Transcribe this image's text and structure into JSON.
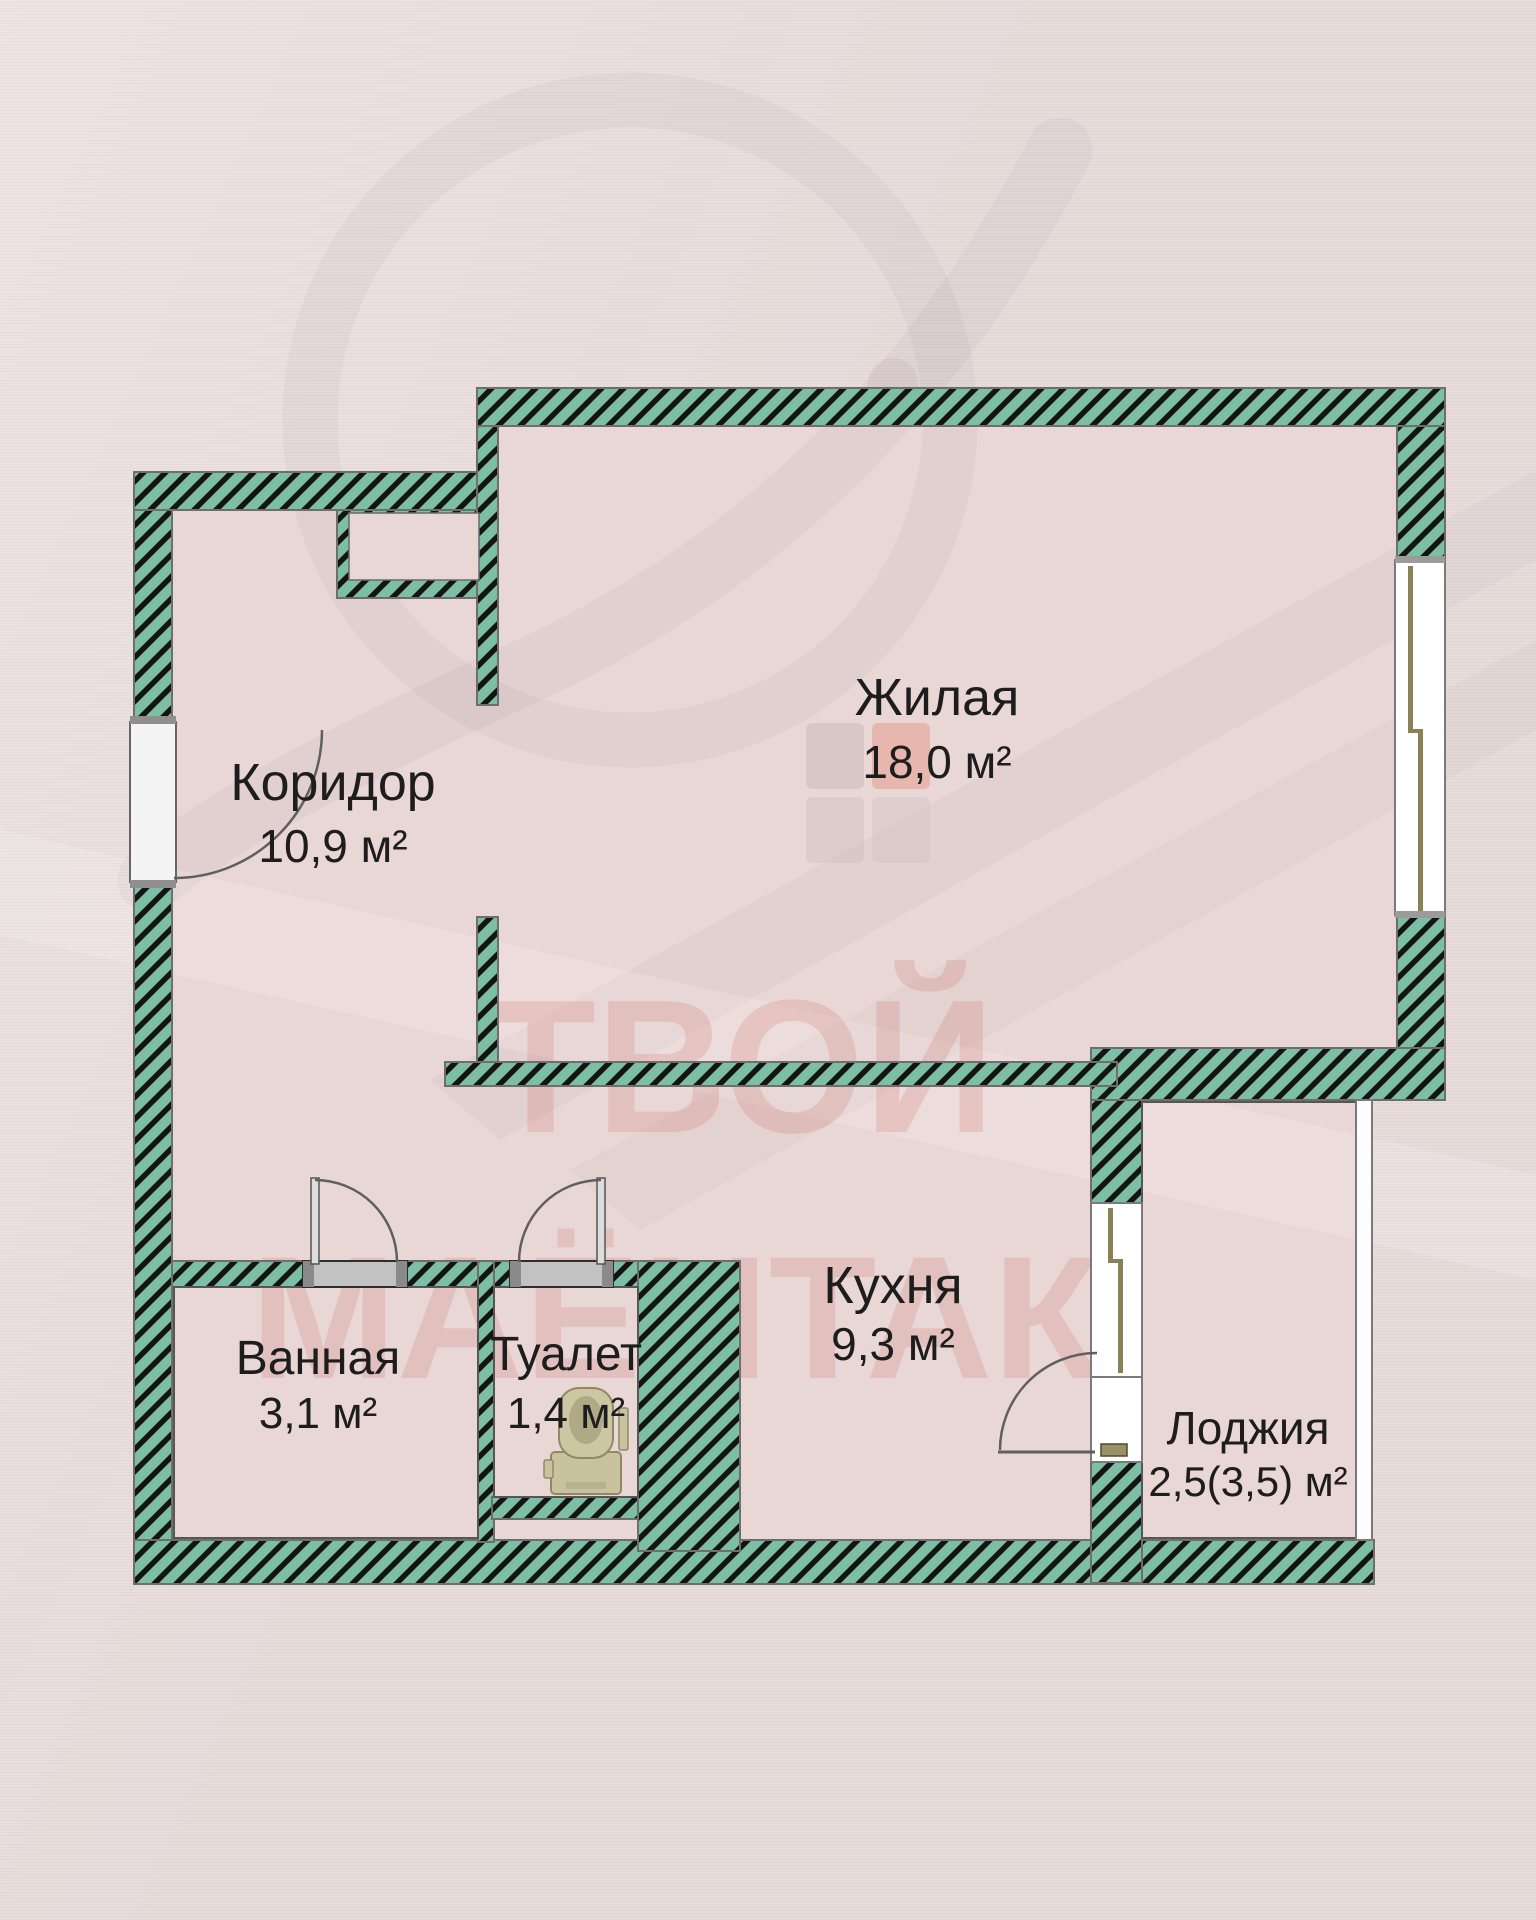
{
  "plan": {
    "title": "apartment-floor-plan",
    "rooms": [
      {
        "id": "living",
        "name": "Жилая",
        "area": "18,0 м²"
      },
      {
        "id": "corridor",
        "name": "Коридор",
        "area": "10,9 м²"
      },
      {
        "id": "kitchen",
        "name": "Кухня",
        "area": "9,3 м²"
      },
      {
        "id": "bathroom",
        "name": "Ванная",
        "area": "3,1 м²"
      },
      {
        "id": "toilet",
        "name": "Туалет",
        "area": "1,4 м²"
      },
      {
        "id": "loggia",
        "name": "Лоджия",
        "area": "2,5(3,5) м²"
      }
    ],
    "watermark": {
      "line1": "ТВОЙ",
      "line2": "МАЁНТАК"
    },
    "colors": {
      "background": "#e8dcdb",
      "room_fill": "#e9d7d6",
      "wall_green": "#7cbfa5",
      "wall_stripe": "#141414",
      "wall_outline": "#6e6e6e",
      "window_frame_khaki": "#8a8157",
      "door_threshold_grey": "#c2c2c2",
      "label_text": "#1d1d1d",
      "watermark_red": "#c96b62",
      "fixture_khaki": "#c9c29f"
    }
  }
}
